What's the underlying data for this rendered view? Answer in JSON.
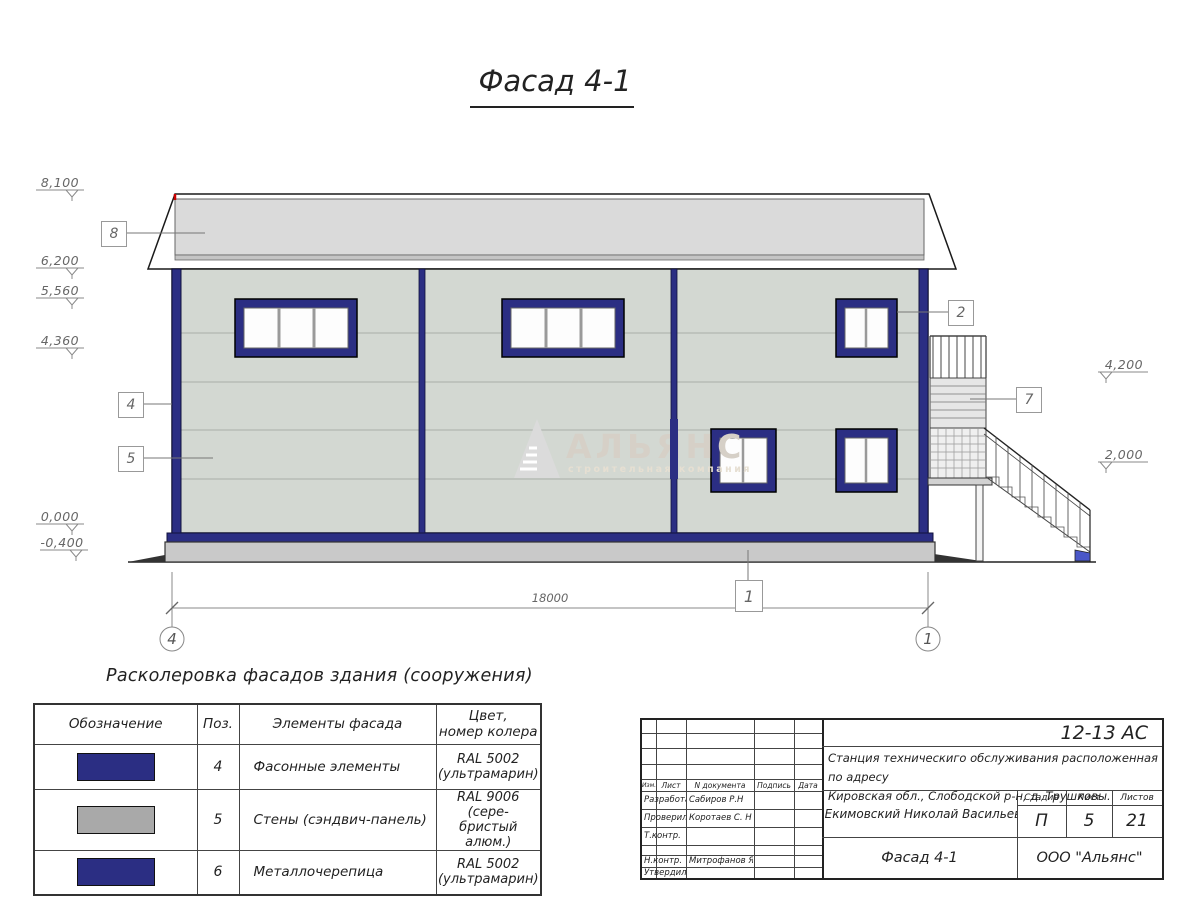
{
  "drawing": {
    "title": "Фасад 4-1",
    "elev_left": [
      "8,100",
      "6,200",
      "5,560",
      "4,360",
      "0,000",
      "-0,400"
    ],
    "elev_right": [
      "4,200",
      "2,000"
    ],
    "callout_roof": "8",
    "callout_corner": "4",
    "callout_wall": "5",
    "callout_window": "2",
    "callout_stair": "7",
    "callout_plinth": "1",
    "dimension_total": "18000",
    "axis_left": "4",
    "axis_right": "1",
    "watermark_title": "АЛЬЯНС",
    "watermark_subtitle": "строительная компания"
  },
  "legend": {
    "title": "Расколеровка фасадов здания (сооружения)",
    "col_designation": "Обозначение",
    "col_pos": "Поз.",
    "col_element": "Элементы фасада",
    "col_color_line1": "Цвет,",
    "col_color_line2": "номер колера",
    "rows": [
      {
        "pos": "4",
        "element": "Фасонные элементы",
        "color1": "RAL 5002",
        "color2": "(ультрамарин)",
        "swatch": "#2b2e83"
      },
      {
        "pos": "5",
        "element": "Стены (сэндвич-панель)",
        "color1": "RAL 9006 (сере-",
        "color2": "бристый алюм.)",
        "swatch": "#a9a9a9"
      },
      {
        "pos": "6",
        "element": "Металлочерепица",
        "color1": "RAL 5002",
        "color2": "(ультрамарин)",
        "swatch": "#2b2e83"
      }
    ]
  },
  "titleblock": {
    "doc_code": "12-13 АС",
    "address1": "Станция техническиго обслуживания расположенная по адресу",
    "address2": "Кировская обл., Слободской р-н, д. Трушковы.",
    "client": "ИП Екимовский Николай Васильевич",
    "drawing_name": "Фасад 4-1",
    "company": "ООО \"Альянс\"",
    "stage_label": "Стадия",
    "stage_value": "П",
    "sheet_label": "Лист",
    "sheet_value": "5",
    "sheets_label": "Листов",
    "sheets_value": "21",
    "h_izm": "Изм.",
    "h_list": "Лист",
    "h_doc": "N документа",
    "h_sign": "Подпись",
    "h_date": "Дата",
    "rows": [
      {
        "role": "Разработал",
        "name": "Сабиров Р.Н"
      },
      {
        "role": "Проверил",
        "name": "Коротаев С. Н"
      },
      {
        "role": "Т.контр.",
        "name": ""
      },
      {
        "role": "",
        "name": ""
      },
      {
        "role": "Н.контр.",
        "name": "Митрофанов Я. А."
      },
      {
        "role": "Утвердил",
        "name": ""
      }
    ]
  },
  "colors": {
    "facade_blue": "#2b2e83",
    "wall_gray": "#d3d8d2",
    "roof_gray": "#dadada"
  }
}
